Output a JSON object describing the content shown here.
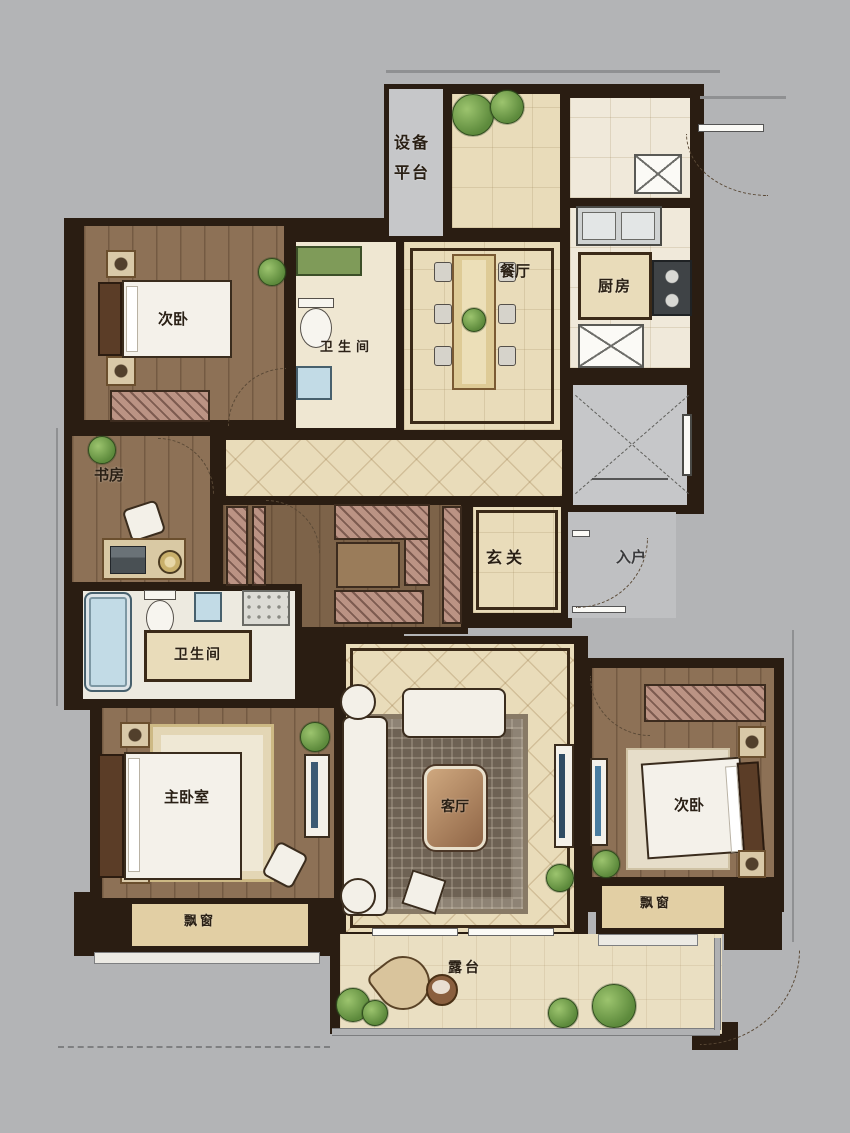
{
  "labels": {
    "equipment_platform": "设备平台",
    "dining": "餐厅",
    "kitchen": "厨房",
    "bedroom_top": "次卧",
    "bath_top": "卫生间",
    "study": "书房",
    "foyer": "玄关",
    "entry": "入户",
    "bath_master": "卫生间",
    "master_bedroom": "主卧室",
    "living": "客厅",
    "bedroom_right": "次卧",
    "bay_window_left": "飘窗",
    "bay_window_right": "飘窗",
    "terrace": "露台"
  },
  "colors": {
    "background": "#b3b4b6",
    "wall": "#2a1d12",
    "wood_floor": "#8d7156",
    "tile_floor": "#e9dcba",
    "marble_floor": "#f0e9da",
    "gray_zone": "#c6c7c9",
    "bay_fill": "#e2cfa4",
    "terrace_floor": "#eadfc2",
    "water_blue": "#c2dbe6",
    "plant_green": "#5d8a3c",
    "rug_living": "#6e6254"
  }
}
